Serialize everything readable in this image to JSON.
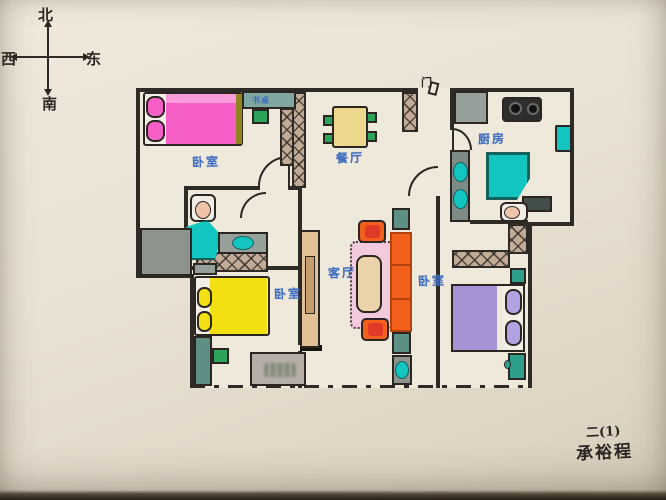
{
  "colors": {
    "paper": "#e9e1d3",
    "ink": "#2b2622",
    "wall": "#2e2a26",
    "blue": "#3e6cc0",
    "hatch": "#c3ac97",
    "bed-pink": "#f65fc5",
    "pink-light": "#fb9bd9",
    "olive": "#8f8420",
    "bed-yellow": "#f2e012",
    "bed-purple": "#a593d6",
    "pillow-purple": "#b2a2e2",
    "desk-teal": "#7fa6a0",
    "desk-teal-dark": "#5d8f85",
    "chair-green": "#2da259",
    "table-yellow": "#ecd88c",
    "cyan": "#12c5c1",
    "cyan-deep": "#11615d",
    "counter-grey": "#95a09b",
    "slate": "#434f4b",
    "orange": "#f2601b",
    "orange-deep": "#b4430e",
    "red": "#e13a29",
    "rug-pink": "#f3c9dd",
    "table-beige": "#ead3a9",
    "tan": "#e2c095",
    "tv-tan": "#c69e6e",
    "peach": "#eec3a8",
    "nightstand-teal": "#2e9f8a",
    "grey-box": "#8d948e",
    "stamp": "#b6afa7"
  },
  "compass": {
    "north": "北",
    "east": "东",
    "south": "南",
    "west": "西"
  },
  "plan": {
    "entry_door": "门",
    "labels": {
      "bedroom_nw": "卧室",
      "desk_nw": "书桌",
      "dining": "餐厅",
      "kitchen": "厨房",
      "living": "客厅",
      "bedroom_sw": "卧室",
      "bedroom_se": "卧室"
    }
  },
  "signature": {
    "line1": "二(1)",
    "line2": "承裕程"
  }
}
